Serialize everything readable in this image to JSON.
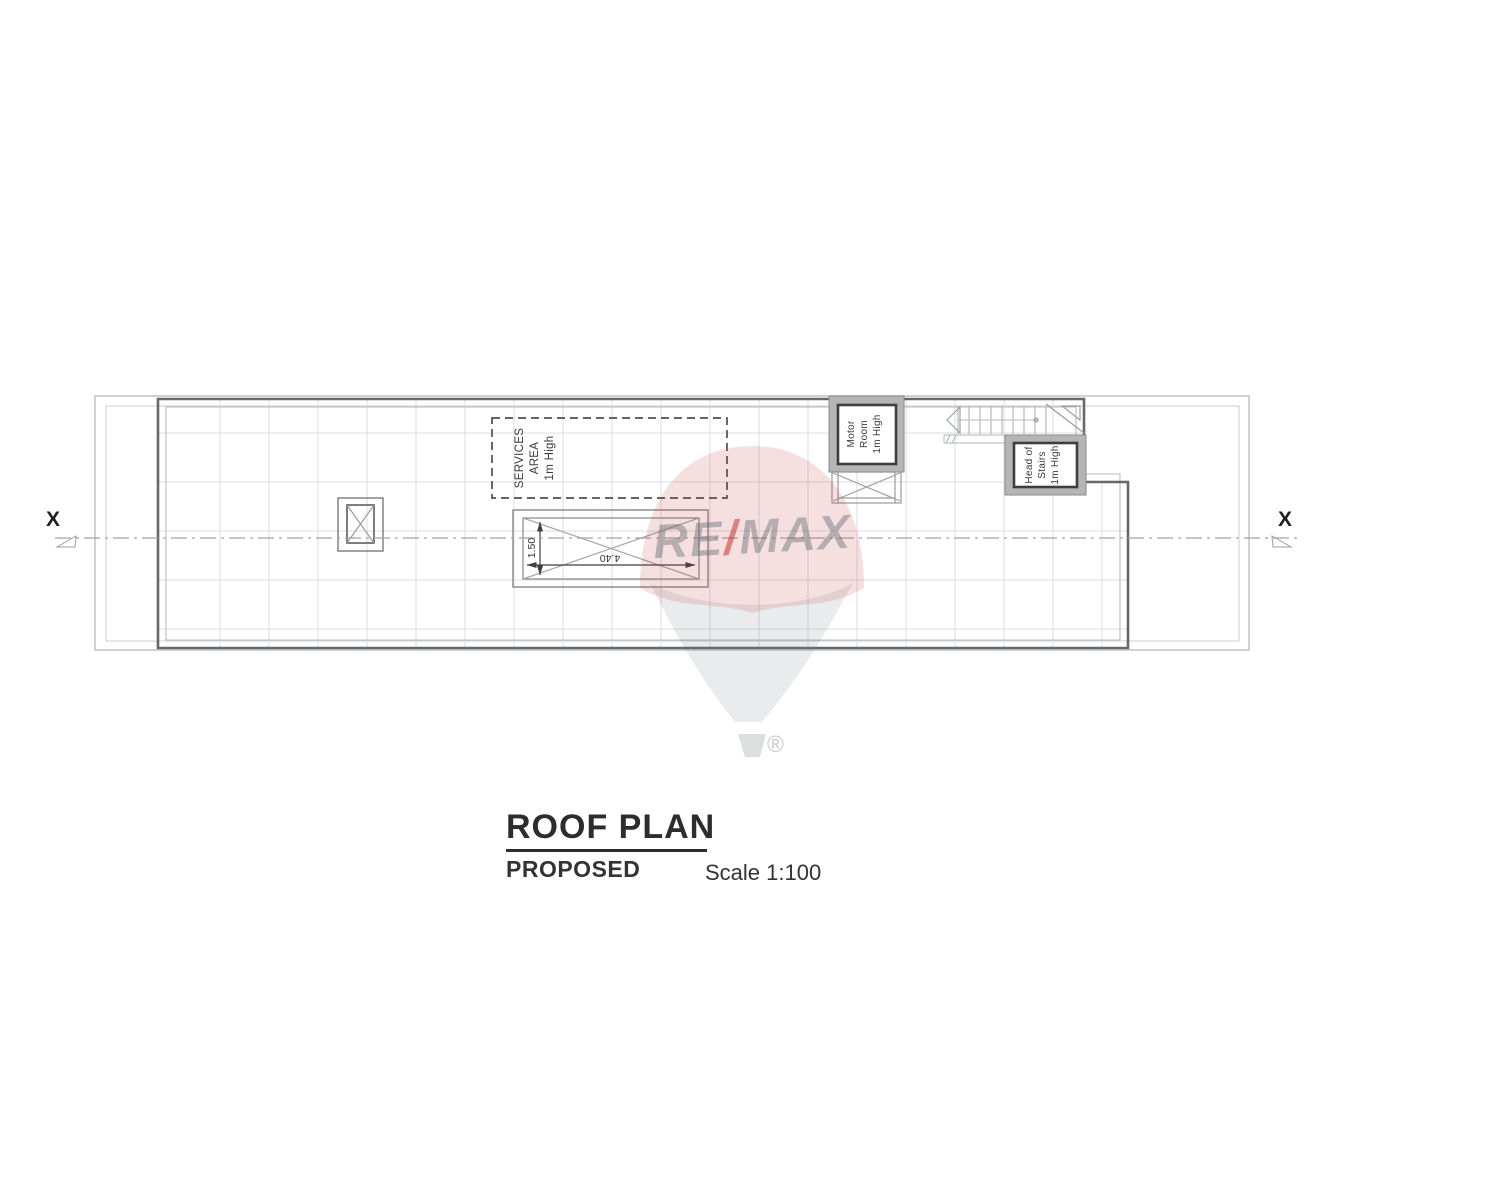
{
  "colors": {
    "slab_line": "#686868",
    "light_line": "#c4c8cb",
    "grid_line": "#dadddf",
    "box_fill": "#b5b5b5",
    "box_border": "#3e3e3e",
    "accent_red": "#c53c34",
    "text": "#2d2d2d"
  },
  "plan": {
    "section_marker_left": "X",
    "section_marker_right": "X",
    "services_area_label": "SERVICES\nAREA\n1m High",
    "motor_room_label": "Motor\nRoom\n1m High",
    "head_of_stairs_label": "Head of\nStairs\n1m High",
    "skylight_width_dim": "4.40",
    "skylight_height_dim": "1.50"
  },
  "title_block": {
    "title": "ROOF PLAN",
    "subtitle": "PROPOSED",
    "scale": "Scale 1:100"
  },
  "watermark": {
    "re": "RE",
    "slash": "/",
    "max": "MAX",
    "registered": "®"
  }
}
